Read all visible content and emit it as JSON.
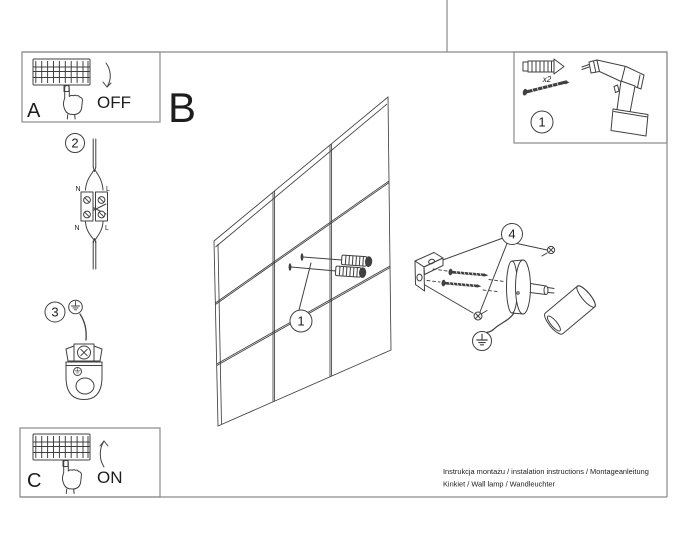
{
  "colors": {
    "background": "#ffffff",
    "frame": "#8a8a8a",
    "ink": "#404040",
    "text": "#1d1d1d"
  },
  "panel_a": {
    "label": "A",
    "state_label": "OFF"
  },
  "panel_c": {
    "label": "C",
    "state_label": "ON"
  },
  "section_label": "B",
  "badges": {
    "step1": "1",
    "step2": "2",
    "step3": "3",
    "step4": "4"
  },
  "hardware_kit": {
    "quantity_label": "x2"
  },
  "wiring": {
    "top_left": "N",
    "top_right": "L",
    "bottom_left": "N",
    "bottom_right": "L"
  },
  "footer": {
    "line1": "Instrukcja montażu / instalation instructions / Montageanleitung",
    "line2": "Kinkiet / Wall lamp / Wandleuchter"
  },
  "icons": {
    "breaker": "circuit-breaker-strip",
    "hand": "pointing-hand",
    "arrow_off": "curved-arrow-down",
    "arrow_on": "curved-arrow-up",
    "wall_plug": "expansion-wall-plug",
    "screw": "mounting-screw",
    "drill": "power-drill",
    "ground": "earth-ground-symbol",
    "wall": "tiled-wall-perspective",
    "lamp": "wall-spot-lamp"
  }
}
